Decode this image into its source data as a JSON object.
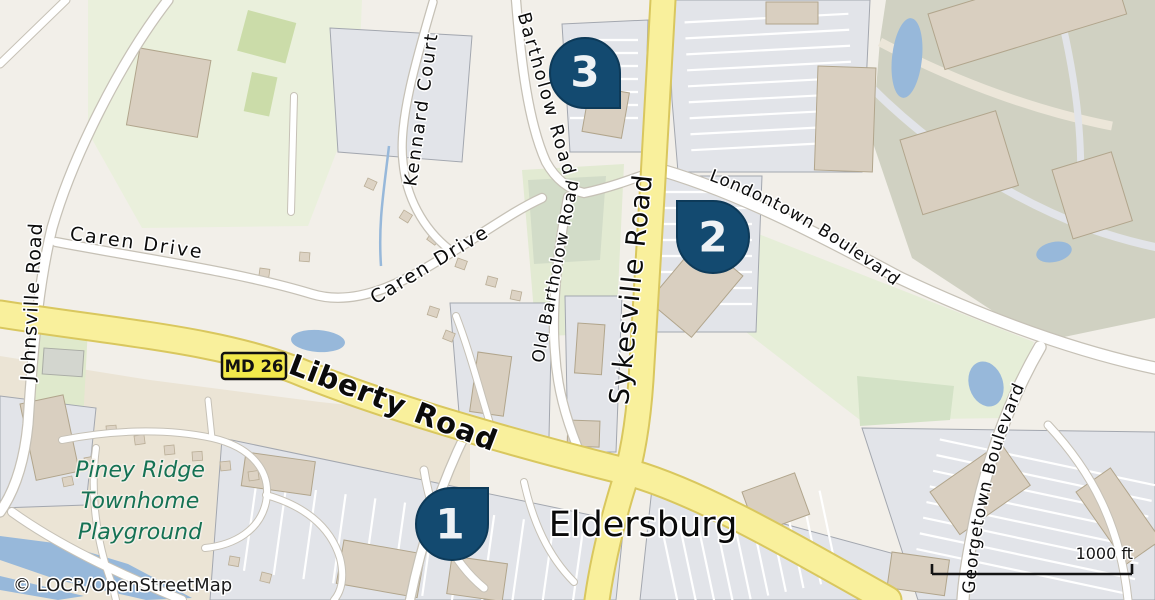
{
  "map": {
    "attribution": "© LOCR/OpenStreetMap",
    "scale": {
      "label": "1000 ft"
    },
    "city_label": "Eldersburg",
    "shield": {
      "label": "MD 26"
    },
    "poi": {
      "line1": "Piney Ridge",
      "line2": "Townhome",
      "line3": "Playground"
    },
    "roads": {
      "johnsville": "Johnsville Road",
      "caren": "Caren Drive",
      "caren2": "Caren Drive",
      "kennard": "Kennard Court",
      "bartholow": "Bartholow Road",
      "old_bartholow": "Old Bartholow Road",
      "sykesville": "Sykesville Road",
      "liberty": "Liberty Road",
      "londontown": "Londontown Boulevard",
      "georgetown": "Georgetown Boulevard"
    },
    "markers": [
      {
        "label": "1"
      },
      {
        "label": "2"
      },
      {
        "label": "3"
      }
    ],
    "colors": {
      "marker_fill": "#134a70",
      "primary_road": "#f9f09c",
      "primary_casing": "#d9c75e",
      "water": "#97b8da",
      "poi_text": "#157254",
      "shield_bg": "#f2e94b"
    }
  }
}
